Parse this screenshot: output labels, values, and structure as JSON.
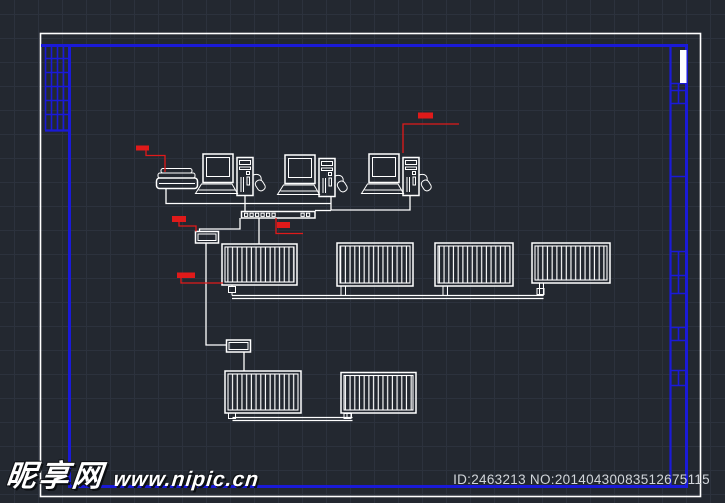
{
  "colors": {
    "background": "#232830",
    "grid_line": "#2c323d",
    "frame_blue": "#1a1ad8",
    "line_white": "#ffffff",
    "annotation_red": "#e01a1a",
    "watermark_white": "#ffffff",
    "id_text": "#d2d6db"
  },
  "watermark": {
    "site_name": "昵享网",
    "site_url": "www.nipic.cn"
  },
  "footer": {
    "id_text": "ID:2463213 NO:20140430083512675115"
  },
  "drawing": {
    "workstations": 3,
    "printers": 1,
    "hub_ports": 8,
    "controller_boxes": 2,
    "radiator_panels": 6,
    "red_annotations": 5
  }
}
